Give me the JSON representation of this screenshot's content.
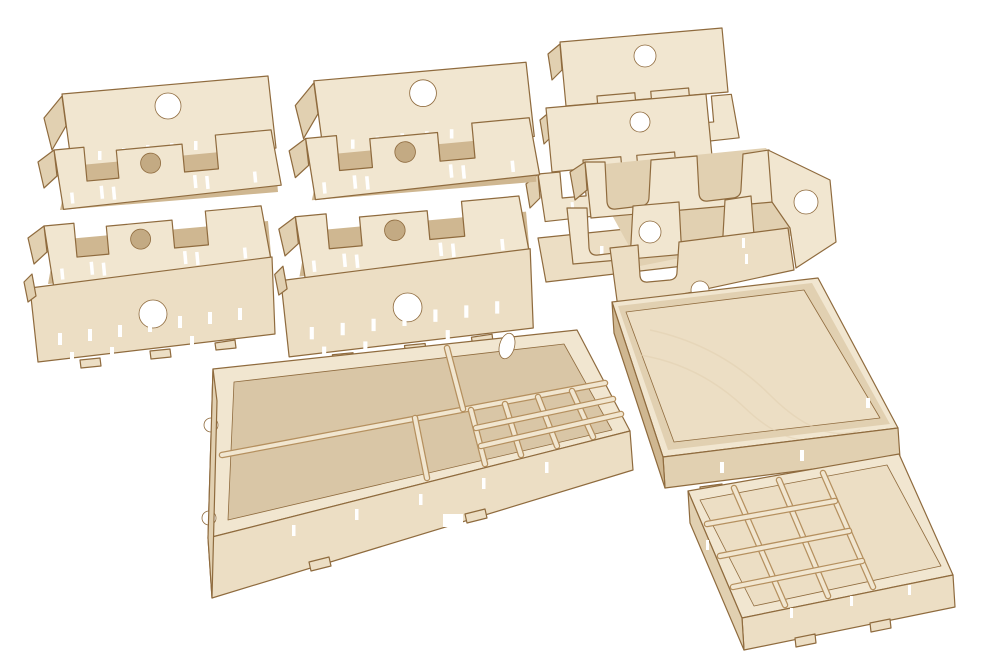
{
  "scene": {
    "description": "Product photo of seven light birch laser-cut board game organizer trays arranged on a pure white background",
    "visible_text": "",
    "objects": [
      {
        "id": "card-tray-left",
        "label": "Card tray with two notched divider rows, round finger holes and tab slots (top left)"
      },
      {
        "id": "card-tray-center",
        "label": "Card tray with two notched divider rows, round finger holes and tab slots (top center)"
      },
      {
        "id": "card-tray-stack",
        "label": "Two nested shallow card trays with tabbed dividers and round holes (top right)"
      },
      {
        "id": "scoop-tray",
        "label": "Token tray with deep U-shaped scoop cutouts in its walls (middle right)"
      },
      {
        "id": "flat-tray",
        "label": "Shallow empty square tray / lid with visible wood grain (right)"
      },
      {
        "id": "organizer-tray-large",
        "label": "Large organizer tray with long compartments, oval hole and small-cell grid (bottom center)"
      },
      {
        "id": "grid-tray-small",
        "label": "Small tray with 3x4 grid of cells and an open bay (bottom right)"
      }
    ]
  },
  "palette": {
    "bg": "#ffffff",
    "ply_light": "#f1e6d0",
    "ply_face": "#ecdec4",
    "ply_mid": "#e1d0b1",
    "ply_dark": "#cfb791",
    "mdf": "#d9c6a6",
    "edge": "#8f6b3e",
    "edge_light": "#b5905f",
    "divot": "#c3aa83"
  }
}
